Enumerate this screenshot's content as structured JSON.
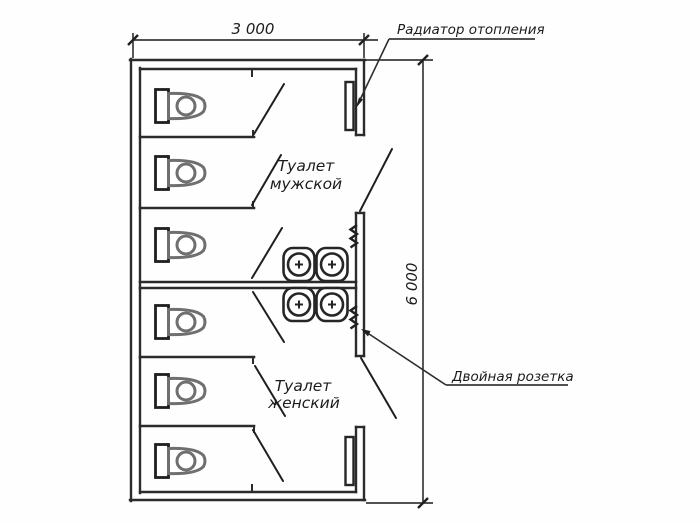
{
  "plan": {
    "dimensions": {
      "width_label": "3 000",
      "height_label": "6 000"
    },
    "rooms": [
      {
        "id": "men",
        "label_line1": "Туалет",
        "label_line2": "мужской"
      },
      {
        "id": "women",
        "label_line1": "Туалет",
        "label_line2": "женский"
      }
    ],
    "annotations": [
      {
        "id": "radiator",
        "label": "Радиатор отопления"
      },
      {
        "id": "double-socket",
        "label": "Двойная розетка"
      }
    ],
    "fixtures": {
      "toilet_stalls": 6,
      "washbasins": 4,
      "radiators": 2,
      "double_sockets": 2
    },
    "colors": {
      "line": "#2b2b2b",
      "fixture_gray": "#6f6f6f",
      "background": "#fefefe"
    }
  }
}
